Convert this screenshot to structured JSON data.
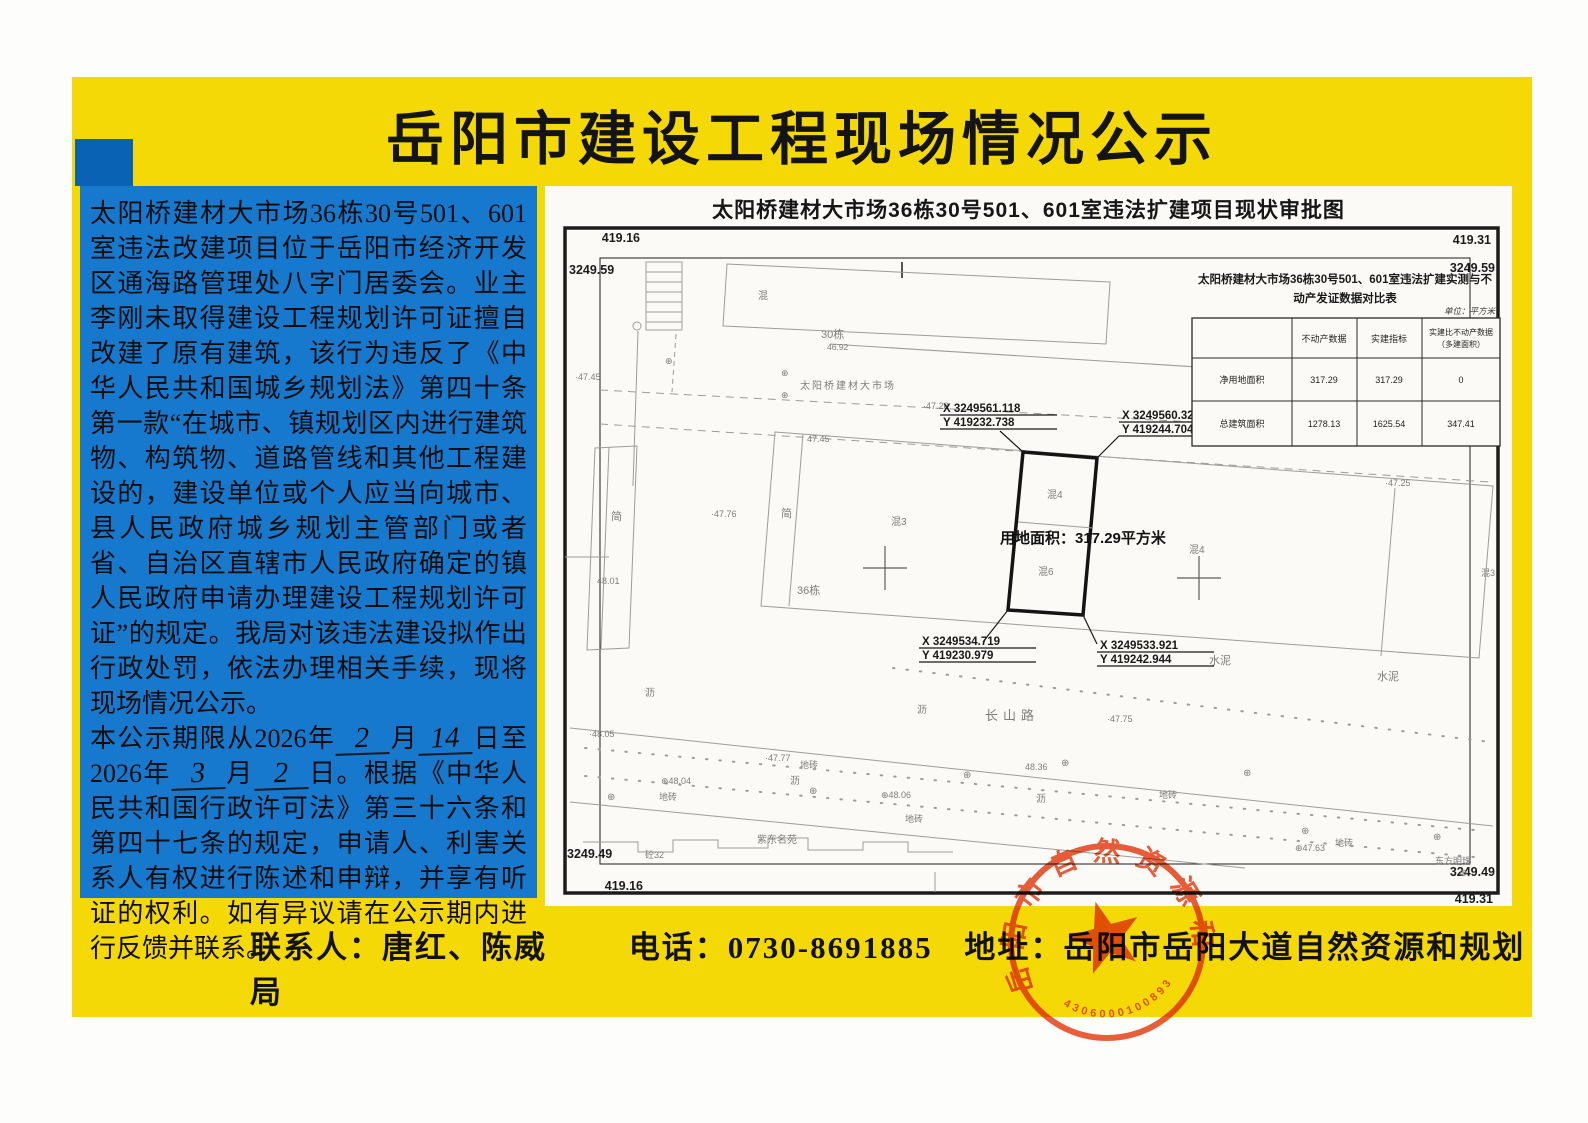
{
  "colors": {
    "poster_yellow": "#f5d907",
    "notice_blue": "#1779ce",
    "stamp_red": "#e8481f",
    "paper": "#fbfaf6"
  },
  "page": {
    "title": "岳阳市建设工程现场情况公示"
  },
  "notice": {
    "p1": "太阳桥建材大市场36栋30号501、601室违法改建项目位于岳阳市经济开发区通海路管理处八字门居委会。业主李刚未取得建设工程规划许可证擅自改建了原有建筑，该行为违反了《中华人民共和国城乡规划法》第四十条第一款“在城市、镇规划区内进行建筑物、构筑物、道路管线和其他工程建设的，建设单位或个人应当向城市、县人民政府城乡规划主管部门或者省、自治区直辖市人民政府确定的镇人民政府申请办理建设工程规划许可证”的规定。我局对该违法建设拟作出行政处罚，依法办理相关手续，现将现场情况公示。",
    "p2_seg1": "本公示期限从2026年",
    "start_month": "2",
    "seg_month1": "月",
    "start_day": "14",
    "seg_day_to": "日至2026年",
    "end_month": "3",
    "seg_month2": "月",
    "end_day": "2",
    "p2_seg2": "日。根据《中华人民共和国行政许可法》第三十六条和第四十七条的规定，申请人、利害关系人有权进行陈述和申辩，并享有听证的权利。如有异议请在公示期内进行反馈并联系。"
  },
  "map": {
    "title": "太阳桥建材大市场36栋30号501、601室违法扩建项目现状审批图",
    "frame": {
      "tl_top": "419.16",
      "tl_side": "3249.59",
      "tr_top": "419.31",
      "tr_side": "3249.59",
      "bl_side": "3249.49",
      "bl_bottom": "419.16",
      "br_side": "3249.49",
      "br_bottom": "419.31"
    },
    "coords": {
      "tl_x": "X 3249561.118",
      "tl_y": "Y 419232.738",
      "tr_x": "X 3249560.321",
      "tr_y": "Y 419244.704",
      "bl_x": "X 3249534.719",
      "bl_y": "Y 419230.979",
      "br_x": "X 3249533.921",
      "br_y": "Y 419242.944"
    },
    "area_label": "用地面积：317.29平方米",
    "labels": {
      "market": "太阳桥建材大市场",
      "bldg30": "30栋",
      "elev4692": "46.92",
      "hun_top": "混",
      "elev4745_edge": "·47.45",
      "elev4745_roof": "47.45",
      "elev4728": "·47.28",
      "elev4776": "·47.76",
      "elev4801": "48.01",
      "jian_left": "简",
      "jian_mid": "简",
      "bldg36": "36栋",
      "hun3_a": "混3",
      "hun3_edge": "混3",
      "hun4_parcel": "混4",
      "hun6_parcel": "混6",
      "hun4_right": "混4",
      "elev4725": "·47.25",
      "shuini_a": "水泥",
      "shuini_b": "水泥",
      "elev4775": "·47.75",
      "li_a": "沥",
      "li_b": "沥",
      "li_c": "沥",
      "li_d": "沥",
      "changshan_road": "长山路",
      "elev4805": "·48.05",
      "elev4777": "·47.77",
      "elev4804": "⊕48.04",
      "elev4806": "⊕48.06",
      "elev4836": "48.36",
      "elev4763": "⊕47.63",
      "dizhuan_a": "地砖",
      "dizhuan_b": "地砖",
      "dizhuan_c": "地砖",
      "dizhuan_d": "地砖",
      "dizhuan_e": "地砖",
      "dongfang": "东方明珠",
      "zidong": "紫东名苑",
      "tong32": "砼32"
    },
    "table": {
      "title1": "太阳桥建材大市场36栋30号501、601室违法扩建实测与不",
      "title2": "动产发证数据对比表",
      "unit": "单位：平方米",
      "col1": "不动产数据",
      "col2": "实建指标",
      "col3a": "实建比不动产数据",
      "col3b": "（多建面积）",
      "rows": [
        [
          "净用地面积",
          "317.29",
          "317.29",
          "0"
        ],
        [
          "总建筑面积",
          "1278.13",
          "1625.54",
          "347.41"
        ]
      ]
    }
  },
  "footer": {
    "contact": "联系人：唐红、陈威",
    "phone": "电话：0730-8691885",
    "address": "地址：岳阳市岳阳大道自然资源和规划局"
  },
  "stamp": {
    "text": "岳阳市自然资源和规划局",
    "number": "4306000100893"
  }
}
